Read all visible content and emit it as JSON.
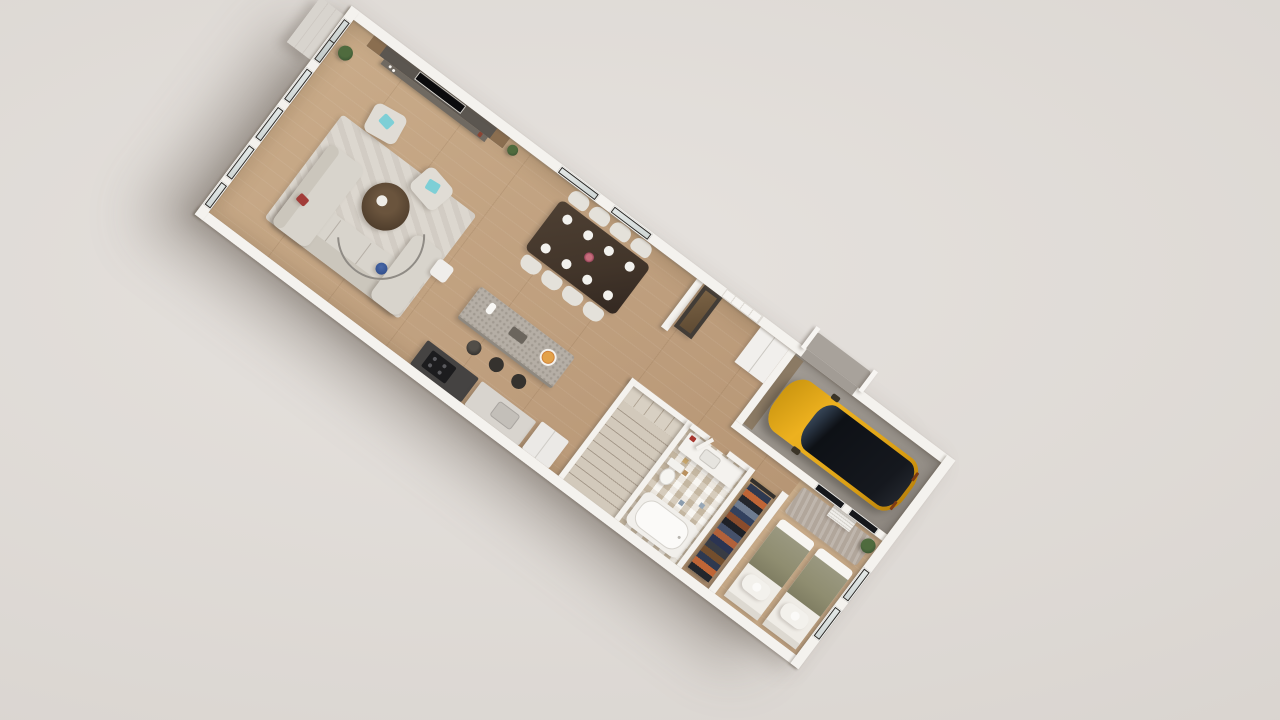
{
  "scene": {
    "type": "3d_floor_plan_render",
    "view": "top-down dollhouse view, plan rotated about 37 degrees, soft studio backdrop",
    "background_color": "#dcd7d3",
    "rooms": [
      {
        "name": "living room",
        "items": [
          "l-shaped sectional sofa",
          "red throw pillow",
          "round wood coffee table",
          "patterned area rug",
          "cube armchair with cyan pillow",
          "cube armchair with cyan pillow",
          "arc floor lamp",
          "blue bowl",
          "side table",
          "tv media wall",
          "potted plant",
          "french doors",
          "window band (4 windows)",
          "entry steps outside"
        ]
      },
      {
        "name": "dining room",
        "items": [
          "dark wood dining table",
          "8 white chairs",
          "8 place settings",
          "flower centerpiece",
          "2 windows"
        ]
      },
      {
        "name": "kitchen",
        "items": [
          "island with speckled counter",
          "3 black bar stools",
          "pizza on plate",
          "paper towel roll",
          "dark cooktop counter",
          "light counter with sink",
          "fridge"
        ]
      },
      {
        "name": "foyer",
        "items": [
          "white paneled front door",
          "tall dark pantry cabinet",
          "double closet"
        ]
      },
      {
        "name": "staircase",
        "items": [
          "l-shaped stair with landing",
          "white stair enclosure"
        ]
      },
      {
        "name": "bathroom",
        "items": [
          "vanity with sink and red towel",
          "toilet",
          "bathtub",
          "mosaic tile floor"
        ]
      },
      {
        "name": "walk-in closet",
        "items": [
          "clothes rack with hanging garments",
          "closet rail"
        ]
      },
      {
        "name": "garage",
        "items": [
          "yellow suv with black roof",
          "concrete floor",
          "garage opening with white posts",
          "driveway apron"
        ]
      },
      {
        "name": "bedroom",
        "items": [
          "twin bed with olive blanket",
          "twin bed with olive blanket",
          "round white pillows",
          "taupe rug",
          "potted plant",
          "radiator",
          "interior glass panels to garage",
          "2 end-wall windows"
        ]
      }
    ],
    "counts": {
      "dining_chairs": 8,
      "bar_stools": 3,
      "beds": 2,
      "left_wall_windows": 4,
      "dining_windows": 2,
      "bedroom_windows": 2
    },
    "palette": {
      "bg1": "#e6e2de",
      "bg2": "#d6d1cc",
      "wall": "#f4f2ee",
      "wood": "#bd9d7c",
      "wood2": "#c9ab89",
      "garageFloor": "#9a948c",
      "tileBase": "#e7e0d2",
      "sofa": "#d8d4cc",
      "sofaBack": "#cbc6bc",
      "rugLiving": "#dcd7cf",
      "rugBedroom": "#b1a69b",
      "tableWood": "#42352a",
      "chairWhite": "#e4e1da",
      "counterDark": "#454342",
      "counterLight": "#d8d4ce",
      "island": "#b5aea5",
      "stool": "#35322e",
      "carYellow": "#e3a81b",
      "carYellowDark": "#b67f0a",
      "carGlass": "#0e1116",
      "blanket": "#8f8d70",
      "linen": "#efece6",
      "accentCyan": "#7ecfd6",
      "accentRed": "#a23c38",
      "accentBlue": "#33518f",
      "plant": "#415c36",
      "mediaWall": "#5b5650",
      "mediaWood": "#8a6e50"
    }
  }
}
